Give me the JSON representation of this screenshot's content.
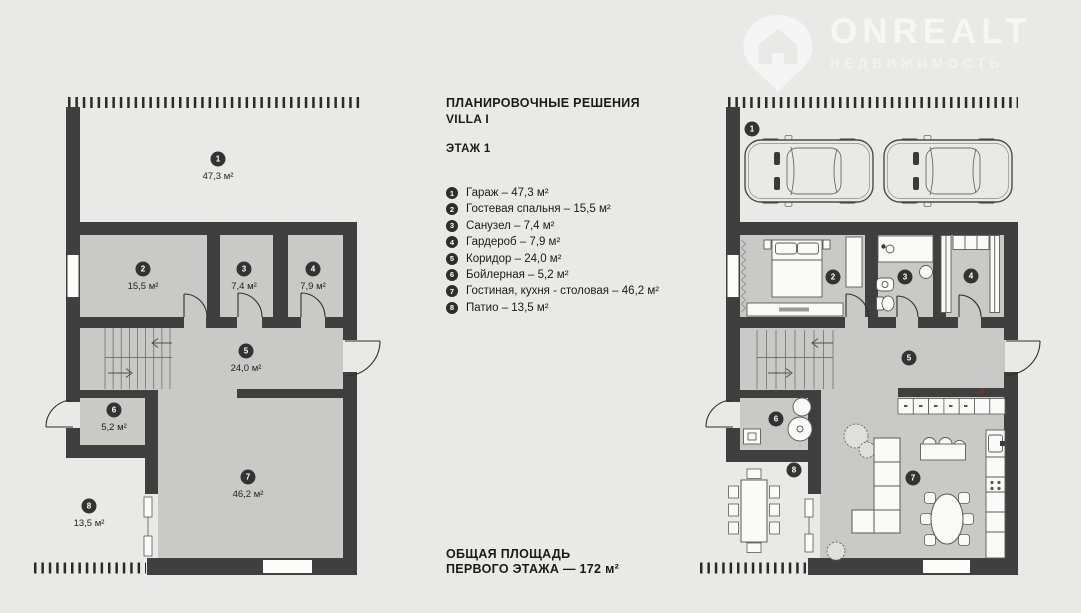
{
  "logo": {
    "name": "ONREALT",
    "subtitle": "НЕДВИЖИМОСТЬ"
  },
  "header": {
    "title": "ПЛАНИРОВОЧНЫЕ РЕШЕНИЯ",
    "villa": "VILLA I",
    "floor": "ЭТАЖ 1"
  },
  "legend": {
    "items": [
      {
        "num": "1",
        "label": "Гараж – 47,3 м²"
      },
      {
        "num": "2",
        "label": "Гостевая спальня – 15,5 м²"
      },
      {
        "num": "3",
        "label": "Санузел – 7,4 м²"
      },
      {
        "num": "4",
        "label": "Гардероб – 7,9 м²"
      },
      {
        "num": "5",
        "label": "Коридор – 24,0 м²"
      },
      {
        "num": "6",
        "label": "Бойлерная – 5,2 м²"
      },
      {
        "num": "7",
        "label": "Гостиная, кухня - столовая – 46,2 м²"
      },
      {
        "num": "8",
        "label": "Патио – 13,5 м²"
      }
    ]
  },
  "total": {
    "line1": "ОБЩАЯ ПЛОЩАДЬ",
    "line2": "ПЕРВОГО ЭТАЖА — 172 м²"
  },
  "plans": {
    "left": {
      "rooms": [
        {
          "num": "1",
          "area": "47,3 м²"
        },
        {
          "num": "2",
          "area": "15,5 м²"
        },
        {
          "num": "3",
          "area": "7,4 м²"
        },
        {
          "num": "4",
          "area": "7,9 м²"
        },
        {
          "num": "5",
          "area": "24,0 м²"
        },
        {
          "num": "6",
          "area": "5,2 м²"
        },
        {
          "num": "7",
          "area": "46,2 м²"
        },
        {
          "num": "8",
          "area": "13,5 м²"
        }
      ]
    },
    "right": {
      "rooms": [
        {
          "num": "1"
        },
        {
          "num": "2"
        },
        {
          "num": "3"
        },
        {
          "num": "4"
        },
        {
          "num": "5"
        },
        {
          "num": "6"
        },
        {
          "num": "7"
        },
        {
          "num": "8"
        }
      ]
    }
  },
  "colors": {
    "background": "#e9e9e8",
    "wall": "#3f3f3f",
    "room_fill": "#c9c9c8",
    "badge": "#333333"
  }
}
